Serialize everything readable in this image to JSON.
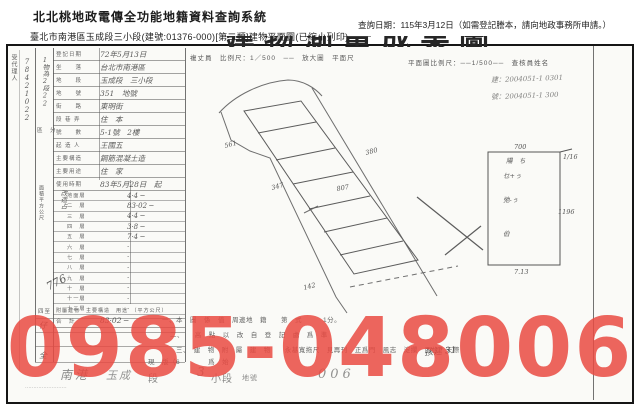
{
  "header": {
    "system_title": "北北桃地政電傳全功能地籍資料查詢系統",
    "query_date": "查詢日期：115年3月12日（如需登記謄本，請向地政事務所申請。）",
    "subtitle": "臺北市南港區玉成段三小段(建號:01376-000)[第二類]建物平面圖(已縮小列印)"
  },
  "watermark": {
    "phone": "0985-048006",
    "color": "rgba(233,74,66,0.85)"
  },
  "document": {
    "clipped_title": "建物測量成果圖",
    "margin_vertical_label": "受代理人",
    "margin_hand_number": "1物為2段22",
    "margin_hand_number2": "78421022",
    "margin_hand_776": "776",
    "section_label_qufen": "區　分",
    "section_label_area": "面積平方公尺",
    "section_label_hand": "改造占",
    "section_label_sizhi": "四至",
    "section_hand_zi": "仔",
    "section_hand_quan": "全",
    "scale_note_left": "複丈員　比例尺：1／500　──　放大圖　平面尺",
    "scale_note_right": "平面圖比例尺：──1/500──　查核員姓名",
    "hand_note1": "建：2004051-1 0301",
    "hand_note2": "號：2004051-1 300",
    "form": {
      "top_rows": [
        {
          "label": "登記日期",
          "value": "72年5月13日"
        },
        {
          "label": "坐　　落",
          "value": "台北市南港區"
        },
        {
          "label": "地　　段",
          "value": "玉成段　三小段"
        },
        {
          "label": "地　　號",
          "value": "351　地號"
        },
        {
          "label": "街　　路",
          "value": "東明街"
        },
        {
          "label": "段 巷 弄",
          "value": "住　本"
        },
        {
          "label": "號　　數",
          "value": "5-1號　2樓"
        },
        {
          "label": "起 造 人",
          "value": "王國五"
        },
        {
          "label": "主要構造",
          "value": "鋼筋混凝土造"
        },
        {
          "label": "主要用途",
          "value": "住　家"
        },
        {
          "label": "使用時期",
          "value": "83年5月28日　起"
        }
      ],
      "floors": [
        {
          "label": "地面層",
          "value": "4·4 ─"
        },
        {
          "label": "二　層",
          "value": "83·02 ─"
        },
        {
          "label": "三　層",
          "value": "4·4 ─"
        },
        {
          "label": "四　層",
          "value": "3·8 ─"
        },
        {
          "label": "五　層",
          "value": "7·4 ─"
        },
        {
          "label": "六　層",
          "value": "·"
        },
        {
          "label": "七　層",
          "value": "·"
        },
        {
          "label": "八　層",
          "value": "·"
        },
        {
          "label": "九　層",
          "value": "·"
        },
        {
          "label": "十　層",
          "value": "·"
        },
        {
          "label": "十一層",
          "value": "·"
        },
        {
          "label": "十二層",
          "value": "·"
        }
      ],
      "total_label": "合　計",
      "total_value": "83·02 ─",
      "annex_header": "附屬建物　主要構造　用途　（平方公尺）"
    },
    "plan_labels": {
      "l561": "561",
      "l347": "347",
      "l807": "807",
      "l380": "380",
      "l142": "142"
    },
    "rect_labels": {
      "top": "700",
      "top_right": "1/16",
      "right": "1196",
      "bottom": "7.13",
      "inside_head": "陽　ち",
      "inside1": "乜+ぅ",
      "inside2": "弛-ぅ",
      "inside3": "伯"
    },
    "notes": [
      "一、本　圖　係　值　周邊地　籍　　第　式　　　1分。",
      "二、　　高　點　以　改　自　登　記　處　爲　準",
      "三、　建　物　附　屬　建　物　　永基寬拖尺　見再刊　正爲門　風志　淀攔　西位　天際",
      "現　版（6　　　　爲　始"
    ],
    "hand_note_bottom": "孩建 31",
    "bottom_row": {
      "hand_nangang": "南港",
      "hand_yucheng": "玉成",
      "print_duan": "段",
      "hand_3": "3",
      "print_xiaoduan": "小段",
      "print_dihao": "地號",
      "hand_006": "006"
    },
    "footer_dashes": "·························"
  }
}
